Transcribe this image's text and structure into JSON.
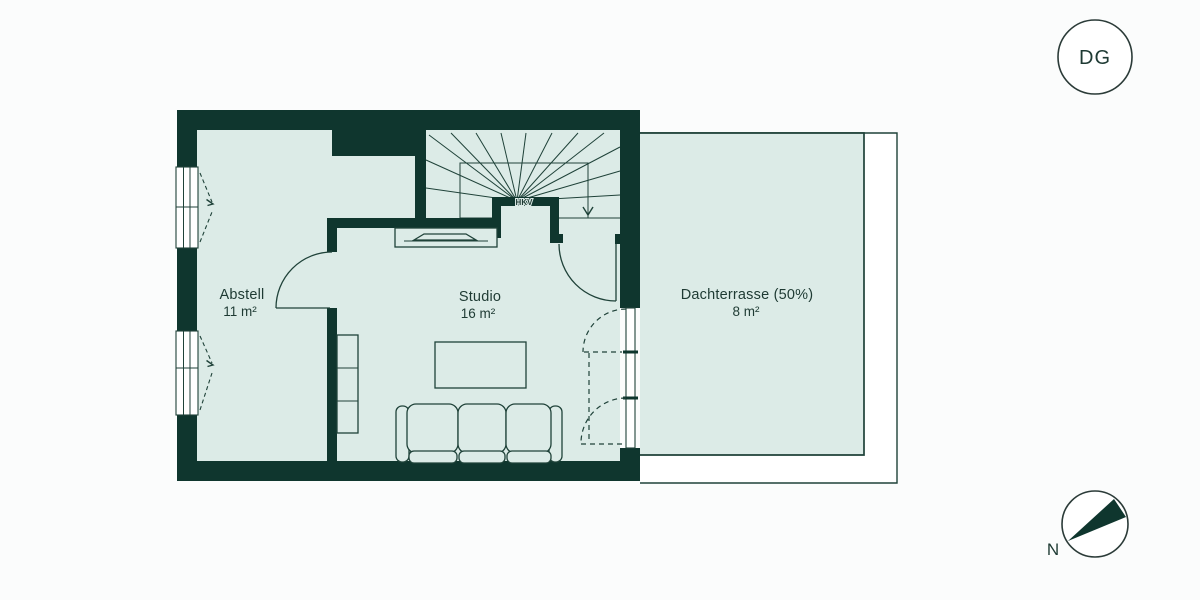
{
  "floor_badge": {
    "label": "DG"
  },
  "compass": {
    "north_label": "N"
  },
  "plan": {
    "rooms": [
      {
        "name": "Abstell",
        "area": "11 m²"
      },
      {
        "name": "Studio",
        "area": "16 m²"
      },
      {
        "name": "Dachterrasse (50%)",
        "area": "8 m²"
      }
    ],
    "labels": {
      "hkv": "HKV"
    }
  },
  "colors": {
    "wall": "#0f362e",
    "floor": "#dcebe7",
    "line": "#1f4239",
    "text": "#1e3a33",
    "background": "#fbfcfc",
    "white": "#ffffff"
  }
}
